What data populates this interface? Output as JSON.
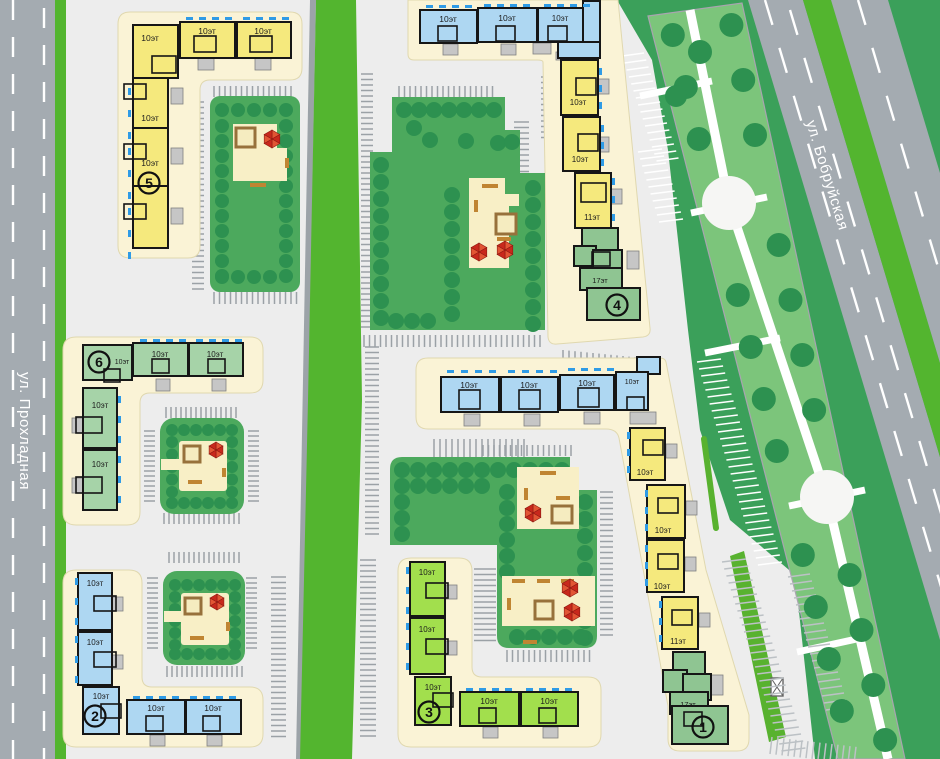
{
  "streets": {
    "left_vertical": "ул. Прохладная",
    "right_diagonal": "ул. Бобруйская"
  },
  "complexes": {
    "c1": {
      "number": "1",
      "buildings": [
        "10эт",
        "10эт",
        "10эт",
        "10эт",
        "10эт",
        "10эт",
        "10эт",
        "11эт",
        "17эт"
      ]
    },
    "c2": {
      "number": "2",
      "buildings": [
        "10эт",
        "10эт",
        "10эт",
        "10эт",
        "10эт"
      ]
    },
    "c3": {
      "number": "3",
      "buildings": [
        "10эт",
        "10эт",
        "10эт",
        "10эт",
        "10эт"
      ]
    },
    "c4": {
      "number": "4",
      "buildings": [
        "10эт",
        "10эт",
        "10эт",
        "10эт",
        "10эт",
        "11эт",
        "17эт"
      ]
    },
    "c5": {
      "number": "5",
      "buildings": [
        "10эт",
        "10эт",
        "10эт",
        "10эт",
        "10эт"
      ]
    },
    "c6": {
      "number": "6",
      "buildings": [
        "10эт",
        "10эт",
        "10эт",
        "10эт",
        "10эт"
      ]
    }
  },
  "legend_colors": {
    "building_10fl_yellow": "#F5E97D",
    "building_10fl_blue": "#AED7F2",
    "building_10fl_sage": "#A6D3A8",
    "building_10fl_lime": "#A2DF4D",
    "building_highrise_green": "#8FC592",
    "park_green": "#4CA95D",
    "boulevard_green": "#7CC57B",
    "dark_green": "#3BA05A",
    "median_green": "#53B52F",
    "road_gray": "#A4ABB1",
    "plot_cream": "#FAF3D6",
    "playground_sand": "#F8EFC6",
    "umbrella_red": "#D83A28",
    "balcony_blue": "#2F9BE6"
  }
}
